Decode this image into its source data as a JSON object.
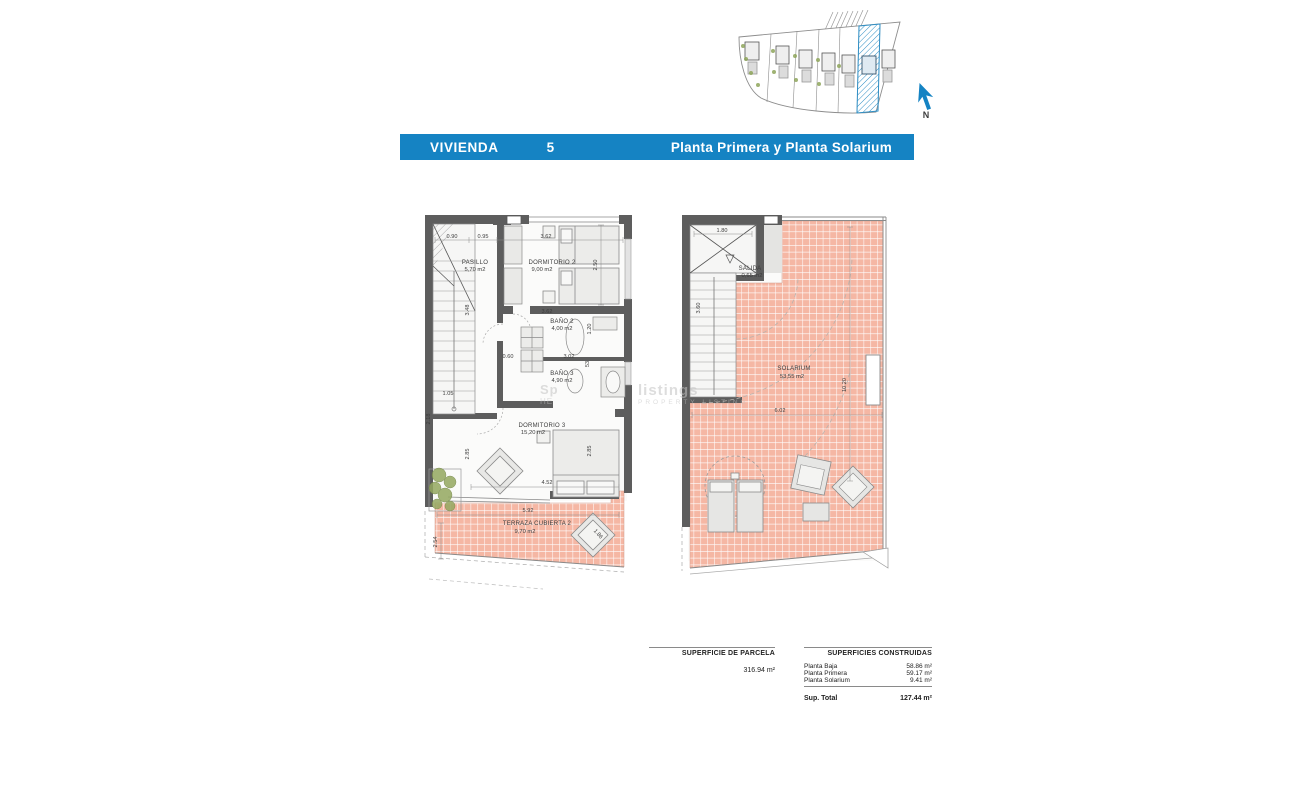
{
  "header": {
    "brand": "VIVIENDA",
    "unit_number": "5",
    "subtitle": "Planta Primera y Planta Solarium",
    "bar_color": "#1583c3"
  },
  "site_plan": {
    "north_label": "N"
  },
  "watermark": {
    "frag1": "Sp",
    "frag2": "HE",
    "line1": "listings",
    "line2": "PROPERTY LISTING"
  },
  "plan_primera": {
    "rooms": {
      "pasillo": {
        "name": "PASILLO",
        "area": "5,70 m2"
      },
      "dormitorio2": {
        "name": "DORMITORIO 2",
        "area": "9,00 m2"
      },
      "bano2": {
        "name": "BAÑO 2",
        "area": "4,00 m2"
      },
      "bano3": {
        "name": "BAÑO 3",
        "area": "4,90 m2"
      },
      "dormitorio3": {
        "name": "DORMITORIO 3",
        "area": "15,20 m2"
      },
      "terraza": {
        "name": "TERRAZA CUBIERTA 2",
        "area": "9,70 m2"
      }
    },
    "dims": {
      "top1": "0.90",
      "top2": "0.95",
      "top3": "3.62",
      "dorm2_h": "2.50",
      "stair_v": "3.48",
      "bano2_w": "3.62",
      "bano2_h": "1.20",
      "shower_w": "0.60",
      "bano3_w": "3.02",
      "bano3_h": "53",
      "entry_w": "1.05",
      "entry_v": "2.18",
      "dorm3_left": "2.85",
      "dorm3_right": "2.85",
      "dorm3_w": "4.52",
      "terraza_w": "5.92",
      "terraza_h": "2.54",
      "lounger": "1.86"
    }
  },
  "plan_solarium": {
    "rooms": {
      "salida": {
        "name": "SALIDA",
        "area": "0,65 m2"
      },
      "solarium": {
        "name": "SOLARIUM",
        "area": "53,55 m2"
      }
    },
    "dims": {
      "top": "1.80",
      "stair_v": "3.60",
      "width": "6.02",
      "height": "10.20"
    }
  },
  "summary": {
    "parcela": {
      "heading": "SUPERFICIE DE PARCELA",
      "value": "316.94 m²"
    },
    "construidas": {
      "heading": "SUPERFICIES CONSTRUIDAS",
      "rows": [
        {
          "label": "Planta Baja",
          "value": "58.86 m²"
        },
        {
          "label": "Planta Primera",
          "value": "59.17 m²"
        },
        {
          "label": "Planta Solarium",
          "value": "9.41 m²"
        }
      ],
      "total_label": "Sup. Total",
      "total_value": "127.44 m²"
    }
  },
  "colors": {
    "accent_blue": "#1583c3",
    "wall_gray": "#5d5d5d",
    "terrace_pink": "#f5b7a4"
  }
}
